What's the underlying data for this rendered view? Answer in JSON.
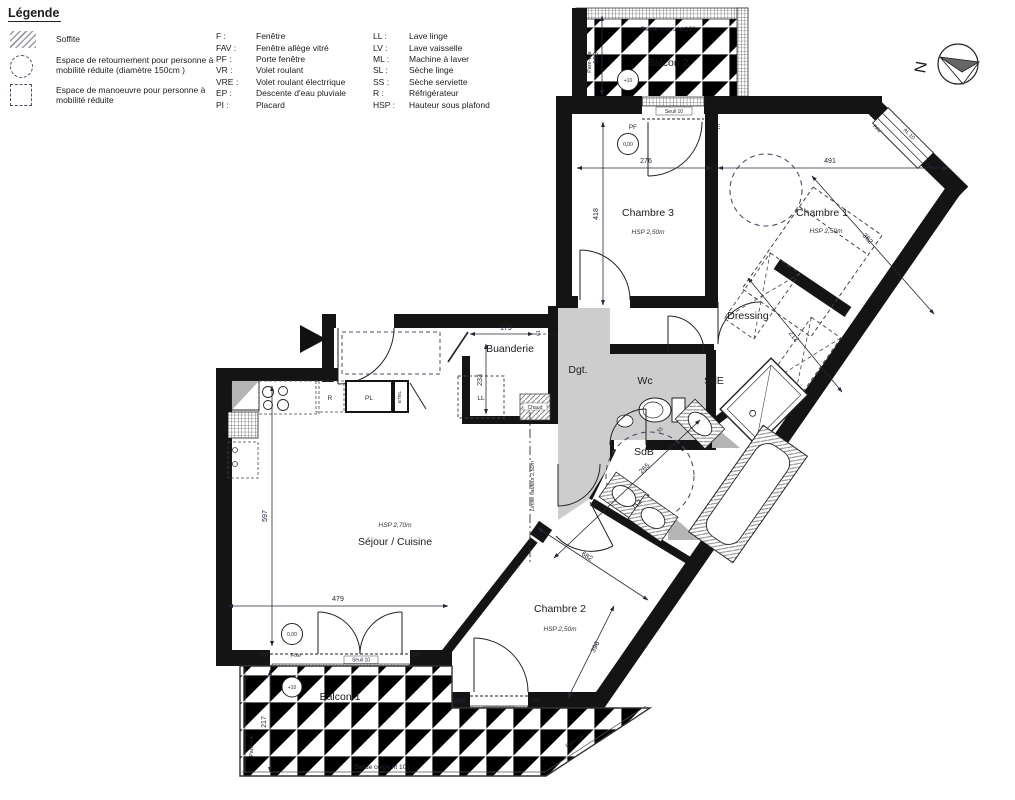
{
  "legend": {
    "title": "Légende",
    "items": [
      {
        "symbol": "hatch-square",
        "label": "Soffite"
      },
      {
        "symbol": "dashed-circle",
        "label": "Espace de retournement pour personne à mobilité réduite (diamètre 150cm )"
      },
      {
        "symbol": "dashed-square",
        "label": "Espace de manoeuvre pour personne à mobilité réduite"
      }
    ],
    "abbr_col1": [
      {
        "abbr": "F :",
        "label": "Fenêtre"
      },
      {
        "abbr": "FAV :",
        "label": "Fenêtre allège vitré"
      },
      {
        "abbr": "PF :",
        "label": "Porte fenêtre"
      },
      {
        "abbr": "VR :",
        "label": "Volet roulant"
      },
      {
        "abbr": "VRE :",
        "label": "Volet roulant électrrique"
      },
      {
        "abbr": "EP :",
        "label": "Descente d'eau pluviale"
      },
      {
        "abbr": "PI :",
        "label": "Placard"
      }
    ],
    "abbr_col2": [
      {
        "abbr": "LL :",
        "label": "Lave linge"
      },
      {
        "abbr": "LV :",
        "label": "Lave vaisselle"
      },
      {
        "abbr": "ML :",
        "label": "Machine à laver"
      },
      {
        "abbr": "SL :",
        "label": "Sèche linge"
      },
      {
        "abbr": "SS :",
        "label": "Sèche serviette"
      },
      {
        "abbr": "R :",
        "label": "Réfrigérateur"
      },
      {
        "abbr": "HSP :",
        "label": "Hauteur sous plafond"
      }
    ]
  },
  "compass": {
    "north": "N"
  },
  "balcony2": {
    "name": "Balcon 2",
    "garde_corps": "Garde corps ht 101",
    "level": "+10",
    "pare_vue": "Pare-vue",
    "dim_width": "188"
  },
  "balcony1": {
    "name": "Balcon 1",
    "garde_corps": "Garde corps ht 101",
    "level": "+10",
    "pare_vue_left": "Pare-vue",
    "pare_vue_right": "Pare-vue",
    "dim_depth": "217"
  },
  "rooms": {
    "chambre3": {
      "name": "Chambre 3",
      "hsp": "HSP 2,50m",
      "level": "0,00",
      "dim_w": "276",
      "dim_h": "418"
    },
    "chambre1": {
      "name": "Chambre 1",
      "hsp": "HSP 2,50m",
      "dim_w": "491",
      "dim_d": "362"
    },
    "dressing": {
      "name": "Dressing",
      "dim": "212"
    },
    "buanderie": {
      "name": "Buanderie",
      "dim_w": "179",
      "dim_w2": "61",
      "dim_h": "233",
      "appliance": "LL",
      "heater": "Chaud"
    },
    "degagement": {
      "name": "Dgt."
    },
    "wc": {
      "name": "Wc",
      "dim": "55"
    },
    "sde": {
      "name": "SdE"
    },
    "sdb": {
      "name": "SdB",
      "dim_diag": "265",
      "dim_w": "112"
    },
    "sejour": {
      "name": "Séjour / Cuisine",
      "hsp": "HSP 2,70m",
      "level": "0,00",
      "dim_h": "597",
      "dim_w": "479",
      "fridge": "R",
      "placard": "PL",
      "etel": "ETEL"
    },
    "chambre2": {
      "name": "Chambre 2",
      "hsp": "HSP 2,50m",
      "dim_l": "682",
      "dim_w": "396"
    }
  },
  "openings": {
    "ch3_window": {
      "left": "PF",
      "right": "VRE",
      "seuil": "Seuil 10"
    },
    "ch1_window": {
      "fav": "FAV",
      "al": "AL 10",
      "vre": "VRE"
    },
    "sejour_window": {
      "vre": "VRE",
      "fixe": "Fixe",
      "pf": "PF",
      "seuil": "Seuil 10"
    },
    "ch2_window": {
      "vre": "VRE",
      "pf": "PF",
      "seuil": "Seuil 10"
    }
  },
  "notes": {
    "limite_hauteur": "Limite hauteur 2,50m"
  }
}
